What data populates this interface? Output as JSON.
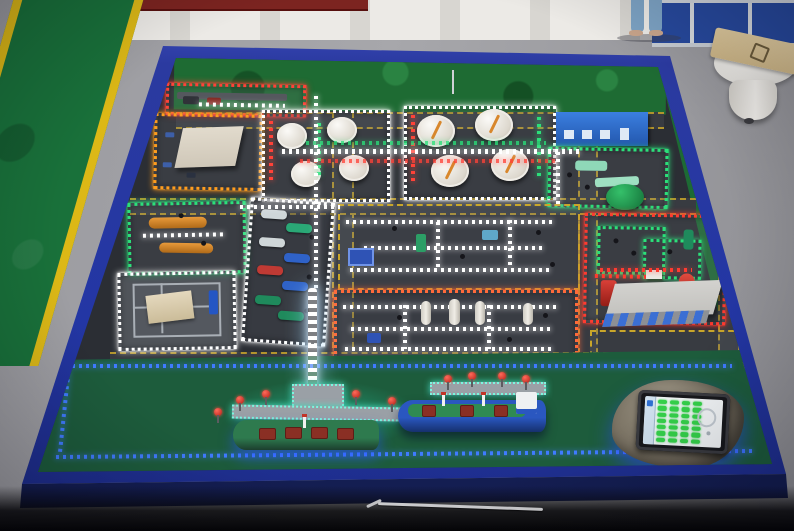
{
  "scene": {
    "type": "photograph",
    "subject": "illuminated physical scale model of a petrochemical port terminal on a blue display table",
    "setting": "training-room floor with green safety mats and partition walls"
  },
  "palette": {
    "floor": "#9d9da2",
    "wall": "#e6e4df",
    "wall-maroon": "#7c2420",
    "partition-blue": "#27499d",
    "mat-green": "#19713a",
    "stripe-yellow": "#dcb816",
    "frame-blue": "#2d42b4",
    "asphalt": "#2b2e34",
    "road-line": "#c9a62a",
    "terrain-green": "#1e6b33",
    "water-blue": "#1d49c0",
    "water-rim-green": "#1d5c3c",
    "led-white": "#ffffff",
    "led-red": "#ff3b30",
    "led-orange": "#ff9d1e",
    "led-green": "#2be07a",
    "led-cyan": "#7df5df",
    "led-blue": "#3f7bff",
    "led-hot-orange": "#ff6a3a",
    "tank-white": "#f1efe9",
    "gauge-needle-orange": "#d8872c",
    "bullet-tank-orange": "#d88a28",
    "building-beige": "#d6cfc2",
    "building-blue": "#2f6fd0",
    "building-gray": "#c7c7c5",
    "ship1-hull-green": "#2e7a4e",
    "ship2-hull-blue": "#2a57c0",
    "deck-green": "#2f8a52",
    "cargo-red": "#8a2f24",
    "dolphin-red": "#d03028",
    "island-rock": "#8d8677",
    "tablet-screen": "#f2f5f7",
    "indicator-green": "#35d24a"
  },
  "environment": {
    "items": [
      {
        "id": "green-floor-mat",
        "name": "green safety mat with yellow edge stripes"
      },
      {
        "id": "maroon-wall-strip",
        "name": "dark red wall base strip"
      },
      {
        "id": "blue-partition",
        "name": "blue office partition panels"
      },
      {
        "id": "person-legs",
        "name": "person standing in jeans"
      },
      {
        "id": "pedestal-table",
        "name": "round white pedestal table with wooden board"
      },
      {
        "id": "pointer-stick",
        "name": "thin metal pointer lying on floor"
      }
    ]
  },
  "model": {
    "table": {
      "frame": "blue plastic display table",
      "surface": "dark asphalt plant layout with yellow-dashed roads",
      "terrain": "green hillside strip along top and right edge"
    },
    "zones": [
      {
        "id": "gantry",
        "name": "truck loading gantry",
        "led": "#ff4238",
        "style": "led"
      },
      {
        "id": "warehouse",
        "name": "warehouse and office building",
        "led": "#ff9d1e",
        "style": "led"
      },
      {
        "id": "tanks-small",
        "name": "small storage tank farm (4 tanks)",
        "led": "#ffffff",
        "style": "led"
      },
      {
        "id": "tanks-large",
        "name": "large floating-roof tank farm (4 tanks)",
        "led": "#ffffff",
        "style": "led"
      },
      {
        "id": "utility",
        "name": "substation with blue building",
        "led": "#2be07a",
        "style": "led"
      },
      {
        "id": "bullets",
        "name": "orange bullet-tank area",
        "led": "#2be07a",
        "style": "led"
      },
      {
        "id": "pump-row",
        "name": "pump bay with colored pump skids",
        "led": "#ffffff",
        "style": "led"
      },
      {
        "id": "process-center",
        "name": "central process unit",
        "led": "#c9a62a",
        "style": "dashed"
      },
      {
        "id": "fire",
        "name": "fire-fighting / foam station with green tank",
        "led": "#ff3b30",
        "style": "led"
      },
      {
        "id": "basin",
        "name": "wastewater basin with cover",
        "led": "#ffffff",
        "style": "led"
      },
      {
        "id": "process-bottom",
        "name": "column process unit",
        "led": "#ff6a3a",
        "style": "led"
      },
      {
        "id": "admin",
        "name": "gray control building",
        "led": "#c9a62a",
        "style": "dashed"
      }
    ],
    "pipelines": [
      {
        "id": "main-horizontal",
        "color": "#ffffff"
      },
      {
        "id": "main-vertical",
        "color": "#ffffff"
      },
      {
        "id": "jetty-trestle",
        "color": "#ffffff",
        "note": "bright LED trestle to the pier"
      }
    ],
    "waterfront": {
      "water": "blue harbor basin with blue LED edge strips",
      "jetties": [
        {
          "id": "jetty-1",
          "name": "T-head berth with red mooring dolphins and teal LED edges"
        },
        {
          "id": "jetty-2",
          "name": "second berth with red mooring dolphins"
        }
      ],
      "ships": [
        {
          "id": "ship-1",
          "name": "green-hull tanker with red deck cargo gear"
        },
        {
          "id": "ship-2",
          "name": "blue-hull carrier with green deck and white stern superstructure"
        }
      ],
      "island": {
        "name": "rock islet",
        "tablet": {
          "name": "control touchscreen",
          "indicator_rows": 7,
          "indicator_cols": 4,
          "indicator_color": "#35d24a"
        }
      }
    }
  }
}
